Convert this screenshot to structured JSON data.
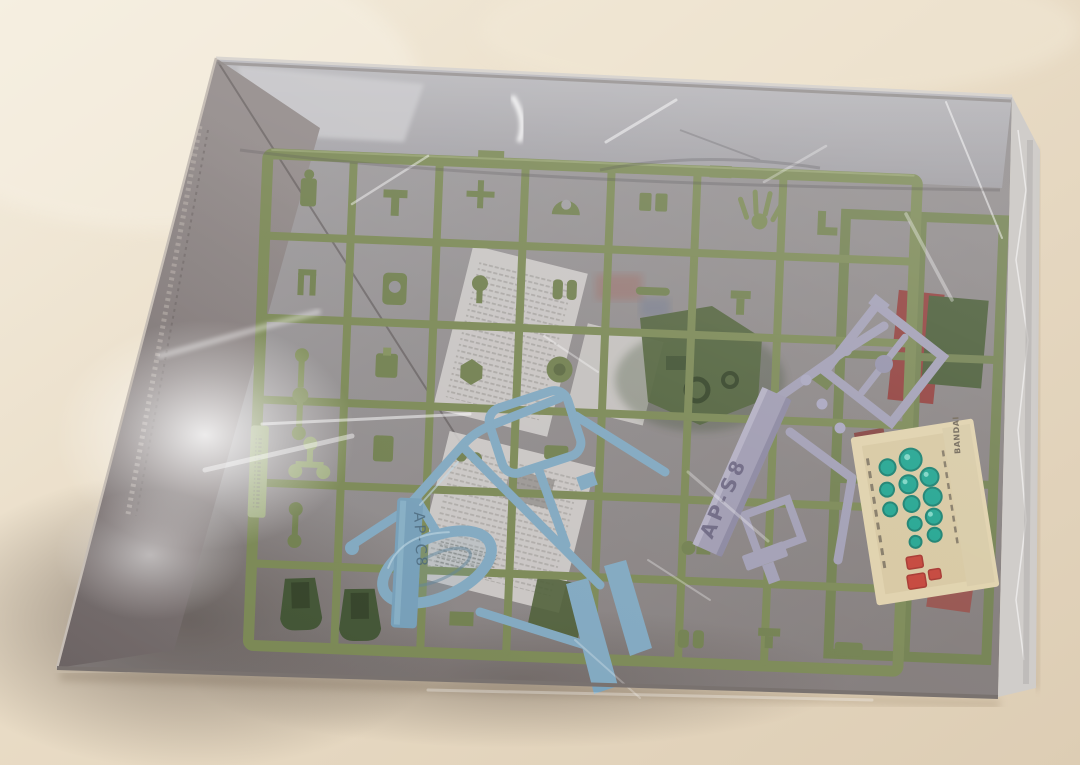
{
  "texts": {
    "lavender_runner_tag": "AP-S8",
    "blue_runner_tag": "AP-C8",
    "sticker_brand": "BANDAI"
  },
  "colors": {
    "table": "#e9dcc6",
    "table_light": "#f4edde",
    "table_dark": "#ddcdb4",
    "box_floor": "#aeacb0",
    "box_interior": "#8e8a8b",
    "wall_dark": "#6a6162",
    "bottom_dark": "#574d4a",
    "olive": "#75834e",
    "olive_light": "#96a370",
    "olive_dark": "#5f6d3d",
    "pale_green": "#9aa878",
    "dark_green": "#3a4d2c",
    "blue": "#7ba4bd",
    "blue_dark": "#3f5d72",
    "lavender": "#9d9ab1",
    "lavender_dark": "#5e5875",
    "red": "#8c3430",
    "paper": "#ccc9c6",
    "sticker_base": "#decfa8",
    "sticker_panel": "#cfc096",
    "sticker_teal": "#17a08b",
    "sticker_teal_dark": "#0e7a69",
    "sticker_red": "#c13a2f",
    "ink": "#6a6050"
  }
}
